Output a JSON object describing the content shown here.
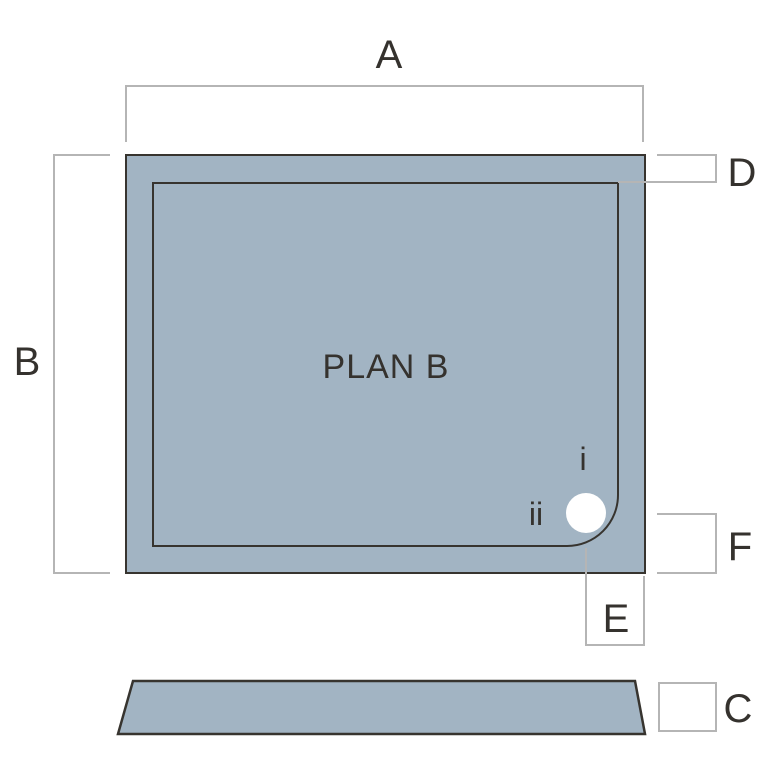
{
  "diagram": {
    "plan_title": "PLAN B",
    "dimension_labels": {
      "a": "A",
      "b": "B",
      "c": "C",
      "d": "D",
      "e": "E",
      "f": "F"
    },
    "waste_markers": {
      "i": "i",
      "ii": "ii"
    },
    "colors": {
      "tray_fill": "#a2b4c3",
      "outline": "#37342f",
      "dimension_line": "#b5b5b5",
      "text": "#35322e",
      "waste_fill": "#ffffff",
      "background": "#ffffff"
    }
  }
}
